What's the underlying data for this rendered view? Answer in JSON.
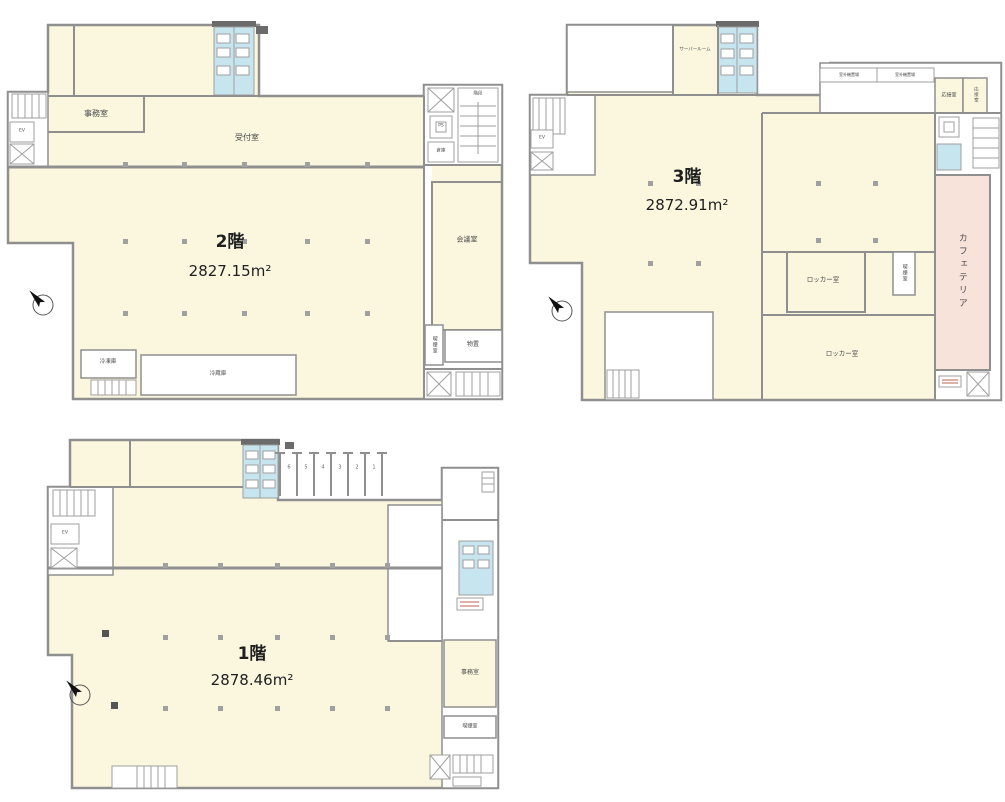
{
  "page": {
    "background": "#ffffff"
  },
  "colors": {
    "floor_fill": "#faf7de",
    "cafeteria_fill": "#f8e3db",
    "toilet_fill": "#c7e5ef",
    "wall": "#8f8f8f",
    "dark_block": "#6b6b6b",
    "text": "#333333"
  },
  "floors": {
    "f2": {
      "title": "2階",
      "area": "2827.15m²",
      "rooms": {
        "office": "事務室",
        "reception": "受付室",
        "meeting": "会議室",
        "freezer": "冷凍庫",
        "refrigerator": "冷蔵庫",
        "storage": "物置",
        "storage_small": "倉庫",
        "smoking": "喫煙室",
        "stairs": "階段",
        "elevator": "EV",
        "pipe_space": "PS"
      }
    },
    "f3": {
      "title": "3階",
      "area": "2872.91m²",
      "rooms": {
        "server_room": "サーバールーム",
        "outdoor_unit_1": "室外機置場",
        "outdoor_unit_2": "室外機置場",
        "reception_room_1": "応接室",
        "reception_room_2": "応接室",
        "cafeteria": "カフェテリア",
        "locker_upper": "ロッカー室",
        "locker_lower": "ロッカー室",
        "smoking": "喫煙室",
        "elevator": "EV"
      }
    },
    "f1": {
      "title": "1階",
      "area": "2878.46m²",
      "rooms": {
        "office": "事務室",
        "smoking": "喫煙室",
        "elevator": "EV"
      },
      "berths": [
        "6",
        "5",
        "4",
        "3",
        "2",
        "1"
      ]
    }
  }
}
